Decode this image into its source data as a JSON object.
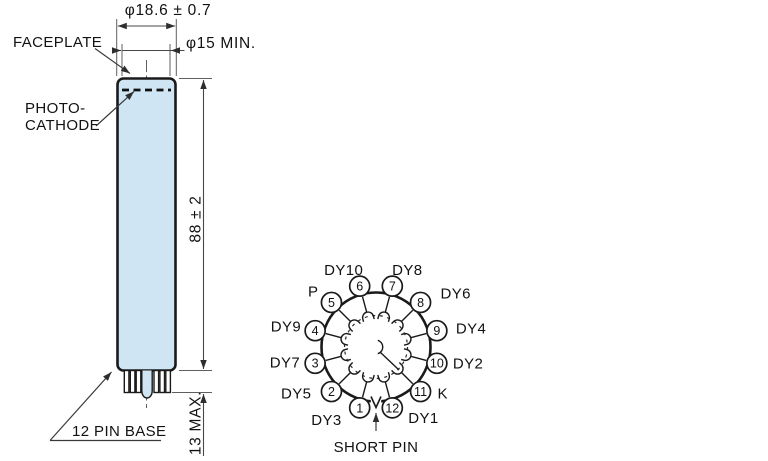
{
  "figure": {
    "type": "photomultiplier-tube-outline-and-basing-diagram"
  },
  "dimensions": {
    "diameter": "φ18.6 ± 0.7",
    "faceplate_diameter": "φ15 MIN.",
    "length": "88 ± 2",
    "pin_length": "13 MAX."
  },
  "labels": {
    "faceplate": "FACEPLATE",
    "photocathode_line1": "PHOTO-",
    "photocathode_line2": "CATHODE",
    "pin_base": "12 PIN BASE"
  },
  "colors": {
    "tube_fill": "#cfe5f3",
    "line": "#1a1a1a",
    "dim_line": "#5f5f5f",
    "text": "#121212"
  },
  "pinout": {
    "short_pin_label": "SHORT PIN",
    "pins": [
      {
        "number": "1",
        "label": "DY3",
        "angle": 195,
        "anchor": "end",
        "dx": -18,
        "dy": 17
      },
      {
        "number": "2",
        "label": "DY5",
        "angle": 225,
        "anchor": "end",
        "dx": -20,
        "dy": 7
      },
      {
        "number": "3",
        "label": "DY7",
        "angle": 255,
        "anchor": "end",
        "dx": -15,
        "dy": 4
      },
      {
        "number": "4",
        "label": "DY9",
        "angle": 285,
        "anchor": "end",
        "dx": -14,
        "dy": 1
      },
      {
        "number": "5",
        "label": "P",
        "angle": 315,
        "anchor": "end",
        "dx": -13,
        "dy": -6
      },
      {
        "number": "6",
        "label": "DY10",
        "angle": 345,
        "anchor": "middle",
        "dx": -16,
        "dy": -11
      },
      {
        "number": "7",
        "label": "DY8",
        "angle": 15,
        "anchor": "middle",
        "dx": 15,
        "dy": -11
      },
      {
        "number": "8",
        "label": "DY6",
        "angle": 45,
        "anchor": "start",
        "dx": 20,
        "dy": -4
      },
      {
        "number": "9",
        "label": "DY4",
        "angle": 75,
        "anchor": "start",
        "dx": 19,
        "dy": 3
      },
      {
        "number": "10",
        "label": "DY2",
        "angle": 105,
        "anchor": "start",
        "dx": 16,
        "dy": 5
      },
      {
        "number": "11",
        "label": "K",
        "angle": 135,
        "anchor": "start",
        "dx": 17,
        "dy": 7
      },
      {
        "number": "12",
        "label": "DY1",
        "angle": 165,
        "anchor": "start",
        "dx": 16,
        "dy": 15
      }
    ]
  }
}
